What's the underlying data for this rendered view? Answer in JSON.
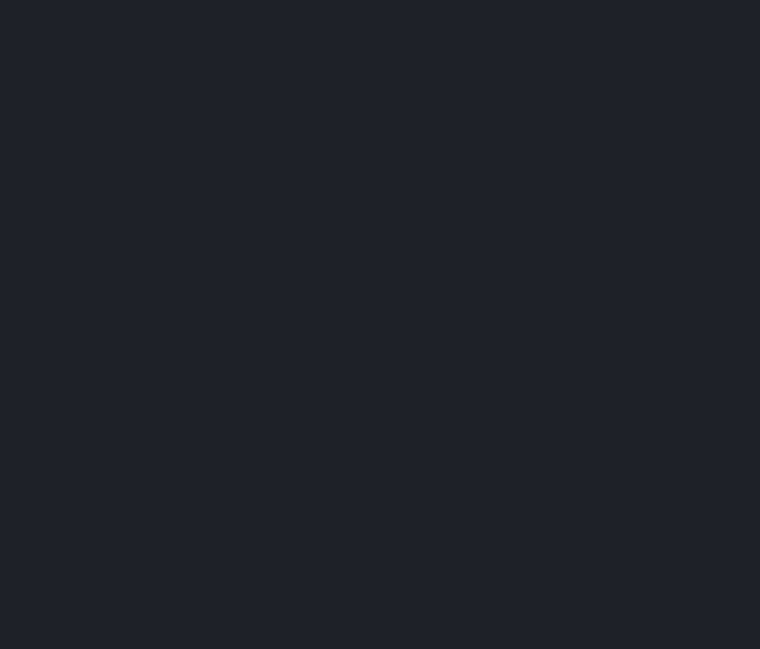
{
  "screen": {
    "background_color": "#1e2127",
    "background_style": "background-color:#1e2127;width:760px;height:649px;"
  }
}
